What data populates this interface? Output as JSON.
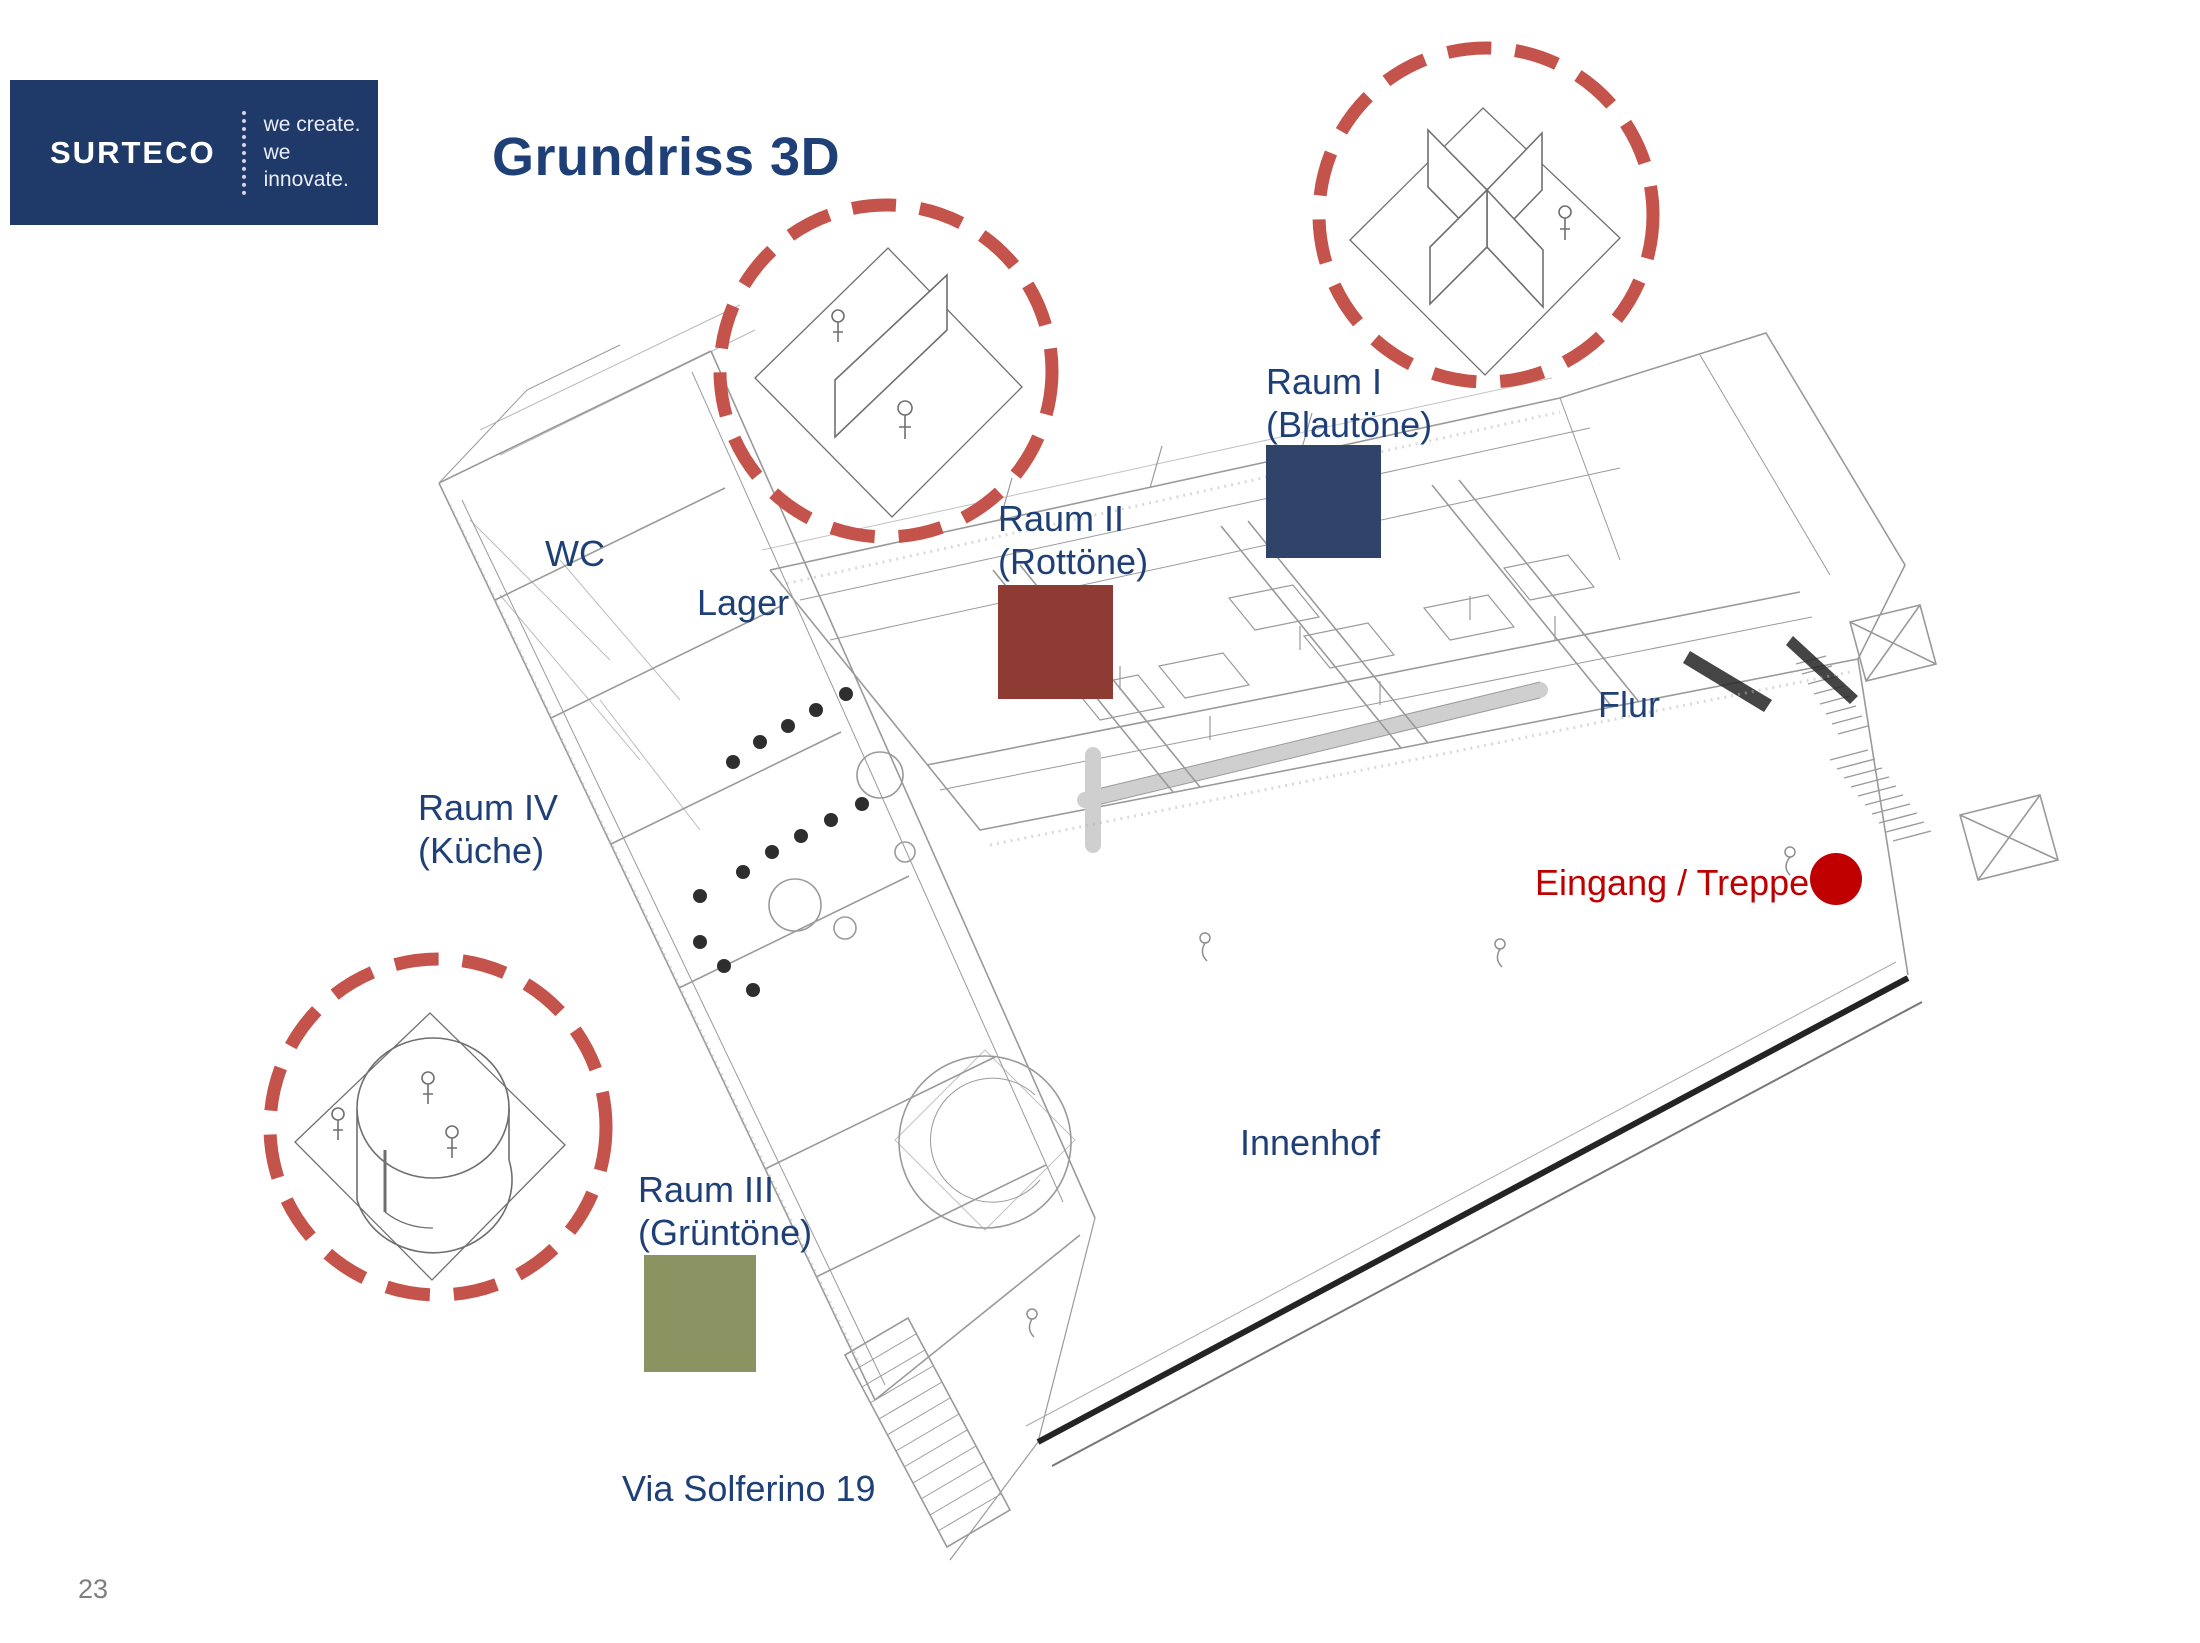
{
  "slide": {
    "title": "Grundriss 3D",
    "page_number": "23"
  },
  "logo": {
    "brand": "SURTECO",
    "tagline_line1": "we create.",
    "tagline_line2": "we innovate."
  },
  "labels": {
    "raum1": {
      "line1": "Raum I",
      "line2": "(Blautöne)",
      "swatch_color": "#2F4468"
    },
    "raum2": {
      "line1": "Raum II",
      "line2": "(Rottöne)",
      "swatch_color": "#8E3B33"
    },
    "raum3": {
      "line1": "Raum III",
      "line2": "(Grüntöne)",
      "swatch_color": "#8B9363"
    },
    "raum4": {
      "line1": "Raum IV",
      "line2": "(Küche)"
    },
    "wc": "WC",
    "lager": "Lager",
    "flur": "Flur",
    "eingang": "Eingang / Treppe",
    "innenhof": "Innenhof",
    "address": "Via Solferino 19"
  },
  "colors": {
    "text_blue": "#1F4077",
    "text_red": "#C00000",
    "marker_red": "#C00000",
    "dashed_circle_red": "#C4534B",
    "logo_blue": "#1F3A68",
    "page_number_gray": "#7F7F7F",
    "sketch_line": "#9A9A9A",
    "sketch_dark": "#242424"
  }
}
